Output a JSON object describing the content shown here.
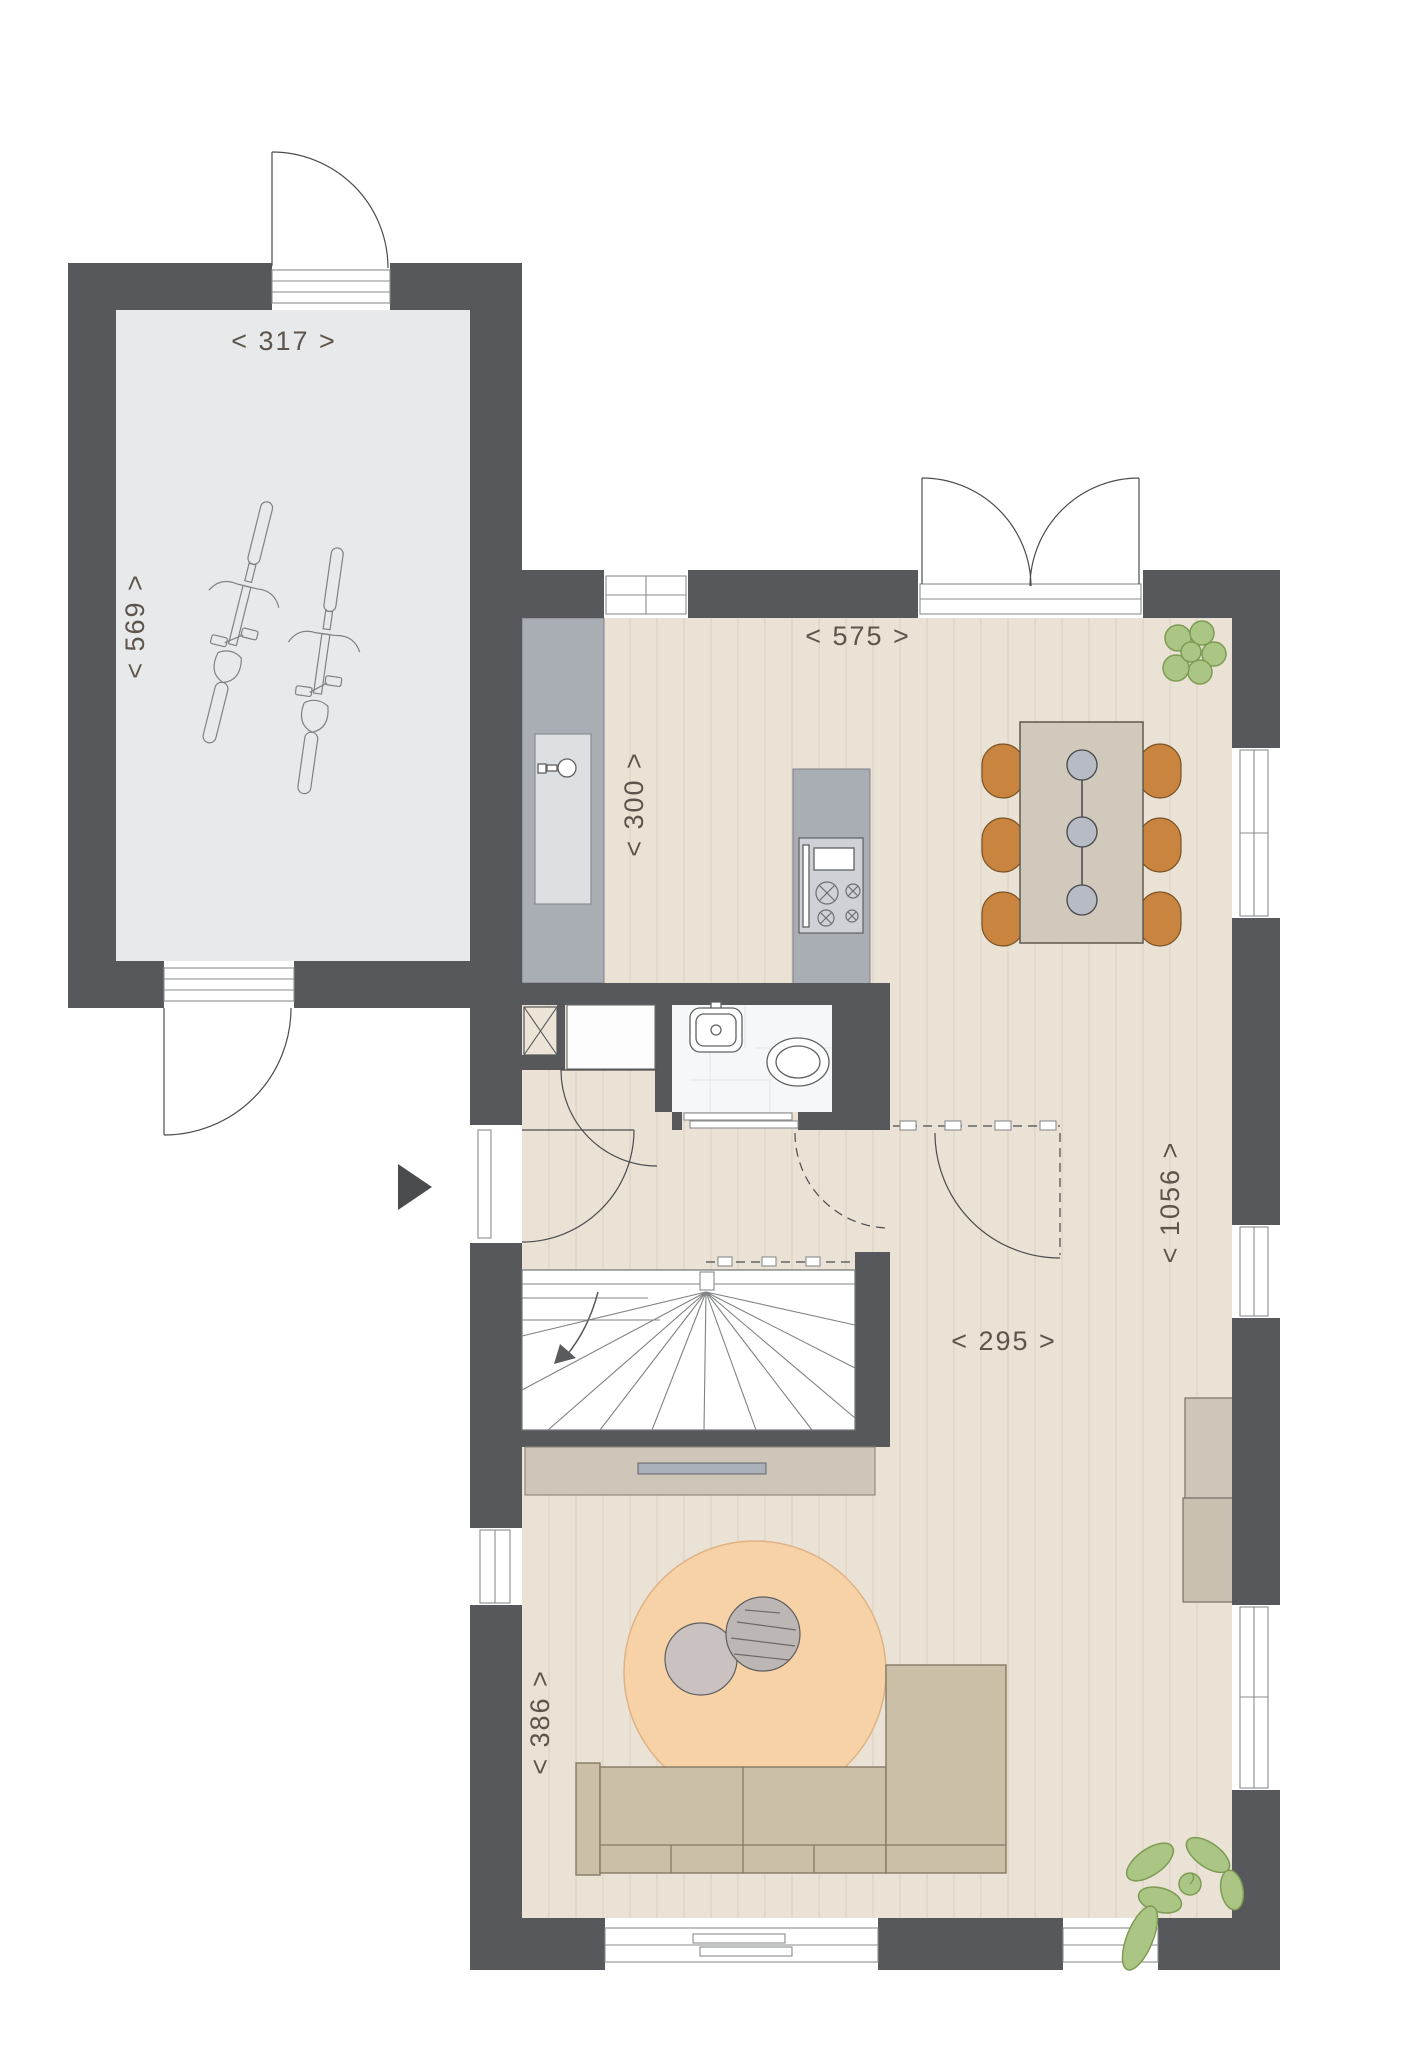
{
  "floor_plan": {
    "dimension_labels": {
      "garage_width": "< 317 >",
      "garage_depth": "< 569 >",
      "top_width": "< 575 >",
      "kitchen_width": "< 300 >",
      "room_depth": "< 1056 >",
      "mid_width": "< 295 >",
      "living_width": "< 386 >"
    },
    "colors": {
      "wall": "#57585b",
      "garage_floor": "#e8e9ea",
      "wood_floor": "#eae2d4",
      "plank_line": "#d9d0c1",
      "counter": "#a9aeb4",
      "cooktop_panel": "#ced2d6",
      "table": "#d1c9bc",
      "chair": "#c9853f",
      "pendant": "#b6bbc4",
      "rug": "#f7d2a7",
      "rug_stroke": "#dfb285",
      "coffee_table": "#c9c2c1",
      "coffee_table_dark": "#bcb6b4",
      "sofa": "#cbbfa8",
      "cabinet": "#cfc6ba",
      "cabinet_dark": "#c9c0b2",
      "handle": "#aab0b8",
      "plant": "#abc584",
      "plant_stroke": "#7d9b53",
      "dimension_text": "#5c554c",
      "arrow": "#4a4b4d",
      "tile_floor": "#f6f7f8"
    }
  }
}
